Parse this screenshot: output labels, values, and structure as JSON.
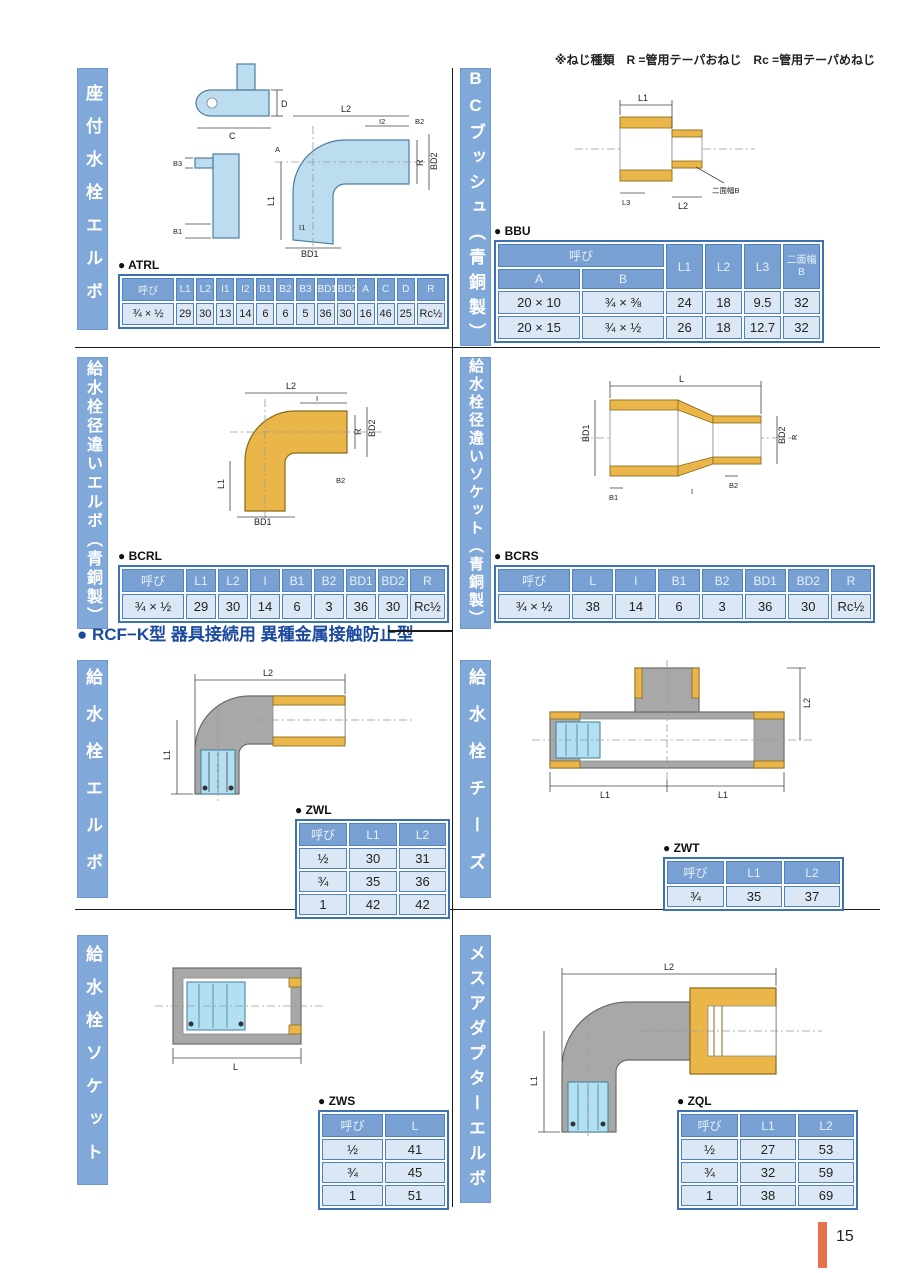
{
  "page": {
    "note": "※ねじ種類　R =管用テーパおねじ　Rc =管用テーパめねじ",
    "rcf_heading": "● RCF−K型 器具接続用 異種金属接触防止型",
    "page_number": "15"
  },
  "sections": {
    "atrl": {
      "title": "座付水栓エルボ",
      "label": "● ATRL"
    },
    "bbu": {
      "title": "BCブッシュ（青銅製）",
      "label": "● BBU"
    },
    "bcrl": {
      "title": "給水栓径違いエルボ（青銅製）",
      "label": "● BCRL"
    },
    "bcrs": {
      "title": "給水栓径違いソケット（青銅製）",
      "label": "● BCRS"
    },
    "zwl": {
      "title": "給水栓エルボ",
      "label": "● ZWL"
    },
    "zwt": {
      "title": "給水栓チーズ",
      "label": "● ZWT"
    },
    "zws": {
      "title": "給水栓ソケット",
      "label": "● ZWS"
    },
    "zql": {
      "title": "メスアダプターエルボ",
      "label": "● ZQL"
    }
  },
  "tables": {
    "atrl": {
      "headers": [
        "呼び",
        "L1",
        "L2",
        "I1",
        "I2",
        "B1",
        "B2",
        "B3",
        "BD1",
        "BD2",
        "A",
        "C",
        "D",
        "R"
      ],
      "rows": [
        [
          "¾ × ½",
          "29",
          "30",
          "13",
          "14",
          "6",
          "6",
          "5",
          "36",
          "30",
          "16",
          "46",
          "25",
          "Rc½"
        ]
      ]
    },
    "bbu": {
      "header": {
        "yobi": "呼び",
        "a": "A",
        "b": "B",
        "l1": "L1",
        "l2": "L2",
        "l3": "L3",
        "flats1": "二面幅",
        "flats2": "B"
      },
      "rows": [
        [
          "20 × 10",
          "¾ × ⅜",
          "24",
          "18",
          "9.5",
          "32"
        ],
        [
          "20 × 15",
          "¾ × ½",
          "26",
          "18",
          "12.7",
          "32"
        ]
      ]
    },
    "bcrl": {
      "headers": [
        "呼び",
        "L1",
        "L2",
        "I",
        "B1",
        "B2",
        "BD1",
        "BD2",
        "R"
      ],
      "rows": [
        [
          "¾ × ½",
          "29",
          "30",
          "14",
          "6",
          "3",
          "36",
          "30",
          "Rc½"
        ]
      ]
    },
    "bcrs": {
      "headers": [
        "呼び",
        "L",
        "I",
        "B1",
        "B2",
        "BD1",
        "BD2",
        "R"
      ],
      "rows": [
        [
          "¾ × ½",
          "38",
          "14",
          "6",
          "3",
          "36",
          "30",
          "Rc½"
        ]
      ]
    },
    "zwl": {
      "headers": [
        "呼び",
        "L1",
        "L2"
      ],
      "rows": [
        [
          "½",
          "30",
          "31"
        ],
        [
          "¾",
          "35",
          "36"
        ],
        [
          "1",
          "42",
          "42"
        ]
      ]
    },
    "zwt": {
      "headers": [
        "呼び",
        "L1",
        "L2"
      ],
      "rows": [
        [
          "¾",
          "35",
          "37"
        ]
      ]
    },
    "zws": {
      "headers": [
        "呼び",
        "L"
      ],
      "rows": [
        [
          "½",
          "41"
        ],
        [
          "¾",
          "45"
        ],
        [
          "1",
          "51"
        ]
      ]
    },
    "zql": {
      "headers": [
        "呼び",
        "L1",
        "L2"
      ],
      "rows": [
        [
          "½",
          "27",
          "53"
        ],
        [
          "¾",
          "32",
          "59"
        ],
        [
          "1",
          "38",
          "69"
        ]
      ]
    }
  },
  "drawings": {
    "atrl": {
      "dims": {
        "d": "D",
        "c": "C",
        "b3": "B3",
        "b1": "B1",
        "l2": "L2",
        "i2": "I2",
        "b2": "B2",
        "a": "A",
        "l1": "L1",
        "i1": "I1",
        "r": "R",
        "bd2": "BD2",
        "bd1": "BD1"
      }
    },
    "bbu": {
      "dims": {
        "l1": "L1",
        "l2": "L2",
        "l3": "L3",
        "flats": "二面幅B"
      }
    },
    "bcrl": {
      "dims": {
        "l2": "L2",
        "i": "I",
        "l1": "L1",
        "r": "R",
        "bd2": "BD2",
        "b2": "B2",
        "bd1": "BD1"
      }
    },
    "bcrs": {
      "dims": {
        "l": "L",
        "i": "I",
        "b1": "B1",
        "b2": "B2",
        "bd1": "BD1",
        "bd2": "BD2",
        "r": "R"
      }
    },
    "zwl": {
      "dims": {
        "l2": "L2",
        "l1": "L1"
      }
    },
    "zwt": {
      "dims": {
        "l2": "L2",
        "l1a": "L1",
        "l1b": "L1"
      }
    },
    "zws": {
      "dims": {
        "l": "L"
      }
    },
    "zql": {
      "dims": {
        "l2": "L2",
        "l1": "L1"
      }
    }
  },
  "colors": {
    "label_bar": "#80a8d8",
    "table_header": "#78a0d2",
    "table_cell": "#dbe7f4",
    "table_border": "#4d82c4",
    "heading_blue": "#1b4aa0",
    "bronze": "#eab64a",
    "body_gray": "#a8a8a8",
    "body_blue": "#bcdcf0",
    "page_bar": "#e8724e"
  }
}
